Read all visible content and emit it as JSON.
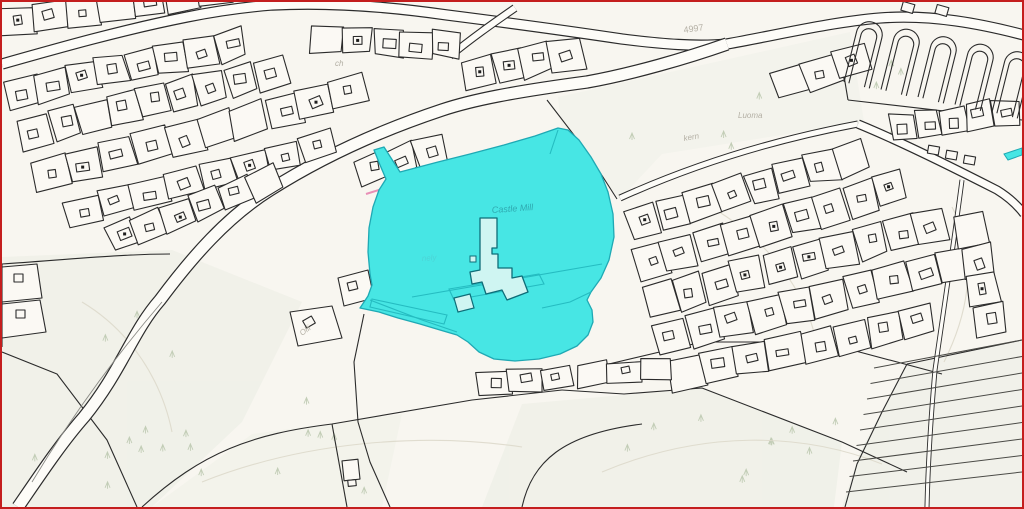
{
  "map": {
    "labels": {
      "road_number": "4997",
      "place_luoma": "Luoma",
      "place_kern": "kern",
      "place_ch": "ch",
      "place_olli": "Olli",
      "selected_parcel_name": "Castle Mill",
      "selected_parcel_note": "nely"
    },
    "colors": {
      "highlight_fill": "#47e6e4",
      "highlight_line": "#1fa9b4",
      "highlight_inner_line": "#25bcc1",
      "highlight_label": "#2fa9b0",
      "highlight_sublabel": "#4cd4d6",
      "outline": "#2b2b2b",
      "frame_border": "#c41e1e",
      "background": "#f8f6f0",
      "land_tint": "#ecefe5",
      "road_fill": "#fdfcf8",
      "faint_label": "#b4b0a5"
    }
  }
}
